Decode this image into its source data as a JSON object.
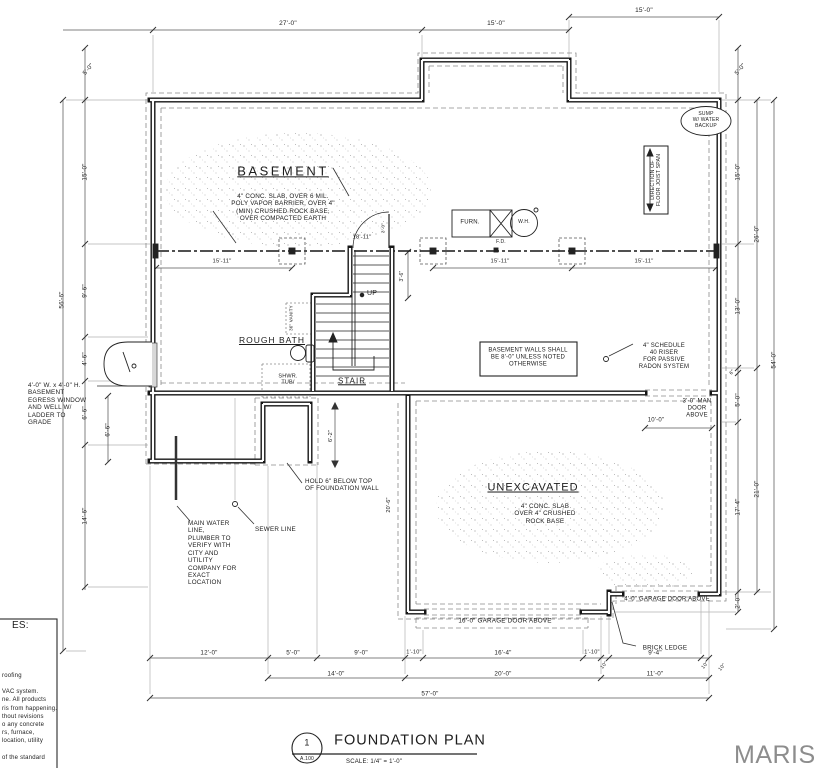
{
  "drawing": {
    "rooms": {
      "basement_title": "BASEMENT",
      "basement_note": "4\" CONC. SLAB, OVER 6 MIL.\nPOLY VAPOR BARRIER, OVER 4\"\n(MIN) CRUSHED ROCK BASE,\nOVER COMPACTED EARTH",
      "unexcavated_title": "UNEXCAVATED",
      "unexcavated_note": "4\" CONC. SLAB\nOVER 4\" CRUSHED\nROCK BASE",
      "stair": "STAIR",
      "up": "UP",
      "rough_bath": "ROUGH BATH",
      "shower_tub": "SHWR.\nTUB/",
      "vanity": "36\" VANITY",
      "furnace": "FURN.",
      "water_heater": "W.H.",
      "floor_drain": "F.D.",
      "sump": "SUMP\nW/ WATER\nBACKUP",
      "joist_direction": "DIRECTION OF\nFLOOR JOIST SPAN"
    },
    "notes": {
      "wall_height": "BASEMENT WALLS SHALL\nBE 8'-0\" UNLESS NOTED\nOTHERWISE",
      "radon": "4\" SCHEDULE\n40 RISER\nFOR PASSIVE\nRADON SYSTEM",
      "man_door": "3'-0\" MAN\nDOOR\nABOVE",
      "egress": "4'-0\" W. x 4'-0\" H.\nBASEMENT\nEGRESS WINDOW\nAND WELL W/\nLADDER TO\nGRADE",
      "hold_below": "HOLD 6\" BELOW TOP\nOF FOUNDATION WALL",
      "water_line": "MAIN WATER\nLINE,\nPLUMBER TO\nVERIFY WITH\nCITY AND\nUTILITY\nCOMPANY FOR\nEXACT\nLOCATION",
      "sewer_line": "SEWER LINE",
      "garage_door_16": "16'-0\" GARAGE DOOR ABOVE",
      "garage_door_4": "4'-0\" GARAGE DOOR ABOVE",
      "brick_ledge": "BRICK LEDGE"
    },
    "dims": {
      "top": [
        "27'-0\"",
        "15'-0\"",
        "15'-0\""
      ],
      "left": [
        "5'-0\"",
        "15'-0\"",
        "9'-6\"",
        "4'-6\"",
        "6'-6\"",
        "6'-6\"",
        "14'-6\"",
        "56'-6\""
      ],
      "right": [
        "5'-0\"",
        "15'-0\"",
        "26'-0\"",
        "13'-0\"",
        "6\"",
        "5'-0\"",
        "21'-0\"",
        "17'-4\"",
        "2'-0\"",
        "54'-0\"",
        "10\""
      ],
      "beam": [
        "15'-11\"",
        "18'-11\"",
        "15'-11\"",
        "15'-11\""
      ],
      "interior": [
        "3'-0\"",
        "3'-6\"",
        "6'-2\"",
        "20'-6\"",
        "10'-0\""
      ],
      "bottom_row1": [
        "12'-0\"",
        "5'-0\"",
        "9'-0\"",
        "1'-10\"",
        "16'-4\"",
        "1'-10\"",
        "10\"",
        "9'-4\"",
        "10\""
      ],
      "bottom_row2": [
        "14'-0\"",
        "20'-0\"",
        "11'-0\""
      ],
      "bottom_overall": "57'-0\""
    },
    "titleblock": {
      "detail_number": "1",
      "sheet": "A.100",
      "title": "FOUNDATION PLAN",
      "scale": "SCALE: 1/4\" = 1'-0\""
    },
    "notes_panel": {
      "header": "ES:",
      "body": "roofing\n\nVAC system.\nne. All products\nris from happening.\nthout revisions\no any concrete\nrs, furnace,\nlocation, utility\n\nof the standard"
    },
    "watermark": "MARIS",
    "colors": {
      "ink": "#1c1c1c",
      "watermark": "#8d8d8d"
    }
  }
}
